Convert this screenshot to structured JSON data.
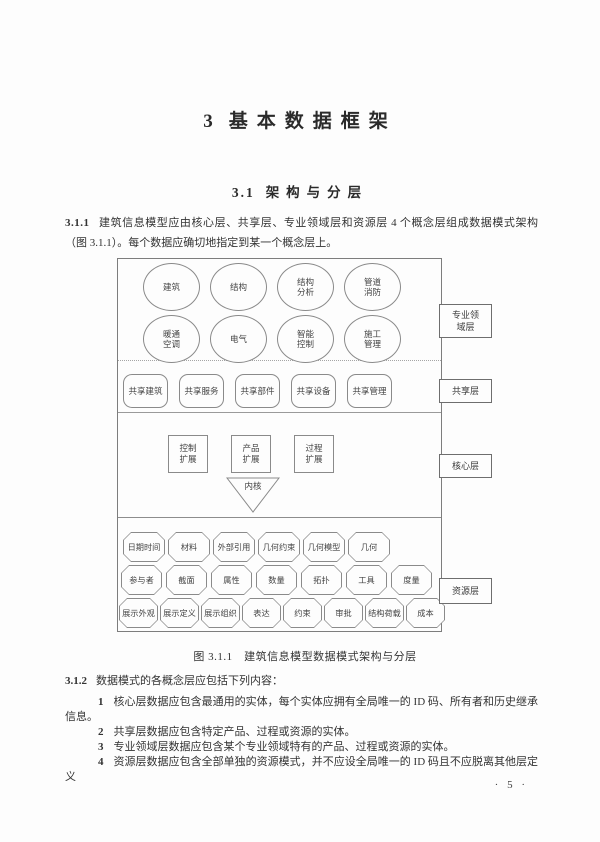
{
  "page": {
    "chapter": {
      "number": "3",
      "title": "基本数据框架"
    },
    "section": {
      "number": "3.1",
      "title": "架构与分层"
    },
    "clause_311": {
      "number": "3.1.1",
      "text": "建筑信息模型应由核心层、共享层、专业领域层和资源层 4 个概念层组成数据模式架构（图 3.1.1）。每个数据应确切地指定到某一个概念层上。"
    },
    "clause_312": {
      "number": "3.1.2",
      "text": "数据模式的各概念层应包括下列内容："
    },
    "items": [
      {
        "number": "1",
        "text": "核心层数据应包含最通用的实体，每个实体应拥有全局唯一的 ID 码、所有者和历史继承信息。"
      },
      {
        "number": "2",
        "text": "共享层数据应包含特定产品、过程或资源的实体。"
      },
      {
        "number": "3",
        "text": "专业领域层数据应包含某个专业领域特有的产品、过程或资源的实体。"
      },
      {
        "number": "4",
        "text": "资源层数据应包含全部单独的资源模式，并不应设全局唯一的 ID 码且不应脱离其他层定义"
      }
    ],
    "page_number": "· 5 ·"
  },
  "figure": {
    "caption": "图 3.1.1　建筑信息模型数据模式架构与分层",
    "layer_labels": [
      "专业领\n域层",
      "共享层",
      "核心层",
      "资源层"
    ],
    "domain_row1": [
      "建筑",
      "结构",
      "结构\n分析",
      "管道\n消防"
    ],
    "domain_row2": [
      "暖通\n空调",
      "电气",
      "智能\n控制",
      "施工\n管理"
    ],
    "shared": [
      "共享建筑",
      "共享服务",
      "共享部件",
      "共享设备",
      "共享管理"
    ],
    "core": [
      "控制\n扩展",
      "产品\n扩展",
      "过程\n扩展"
    ],
    "kernel": "内核",
    "resource_row1": [
      "日期时间",
      "材料",
      "外部引用",
      "几何约束",
      "几何模型",
      "几何"
    ],
    "resource_row2": [
      "参与者",
      "截面",
      "属性",
      "数量",
      "拓扑",
      "工具",
      "度量"
    ],
    "resource_row3": [
      "展示外观",
      "展示定义",
      "展示组织",
      "表达",
      "约束",
      "审批",
      "结构荷载",
      "成本"
    ]
  },
  "colors": {
    "text": "#333333",
    "diagram_line": "#8a8a8a",
    "background": "#fdfdfd"
  }
}
